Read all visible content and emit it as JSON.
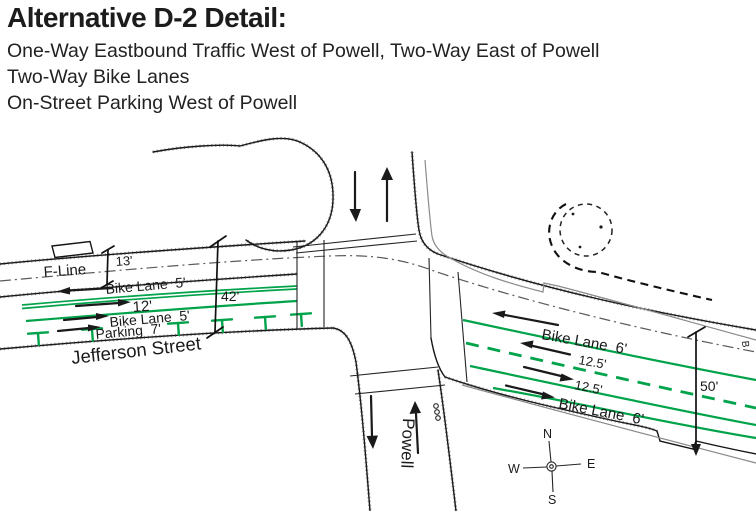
{
  "header": {
    "title": "Alternative D-2 Detail:",
    "line1": "One-Way Eastbound Traffic West of Powell, Two-Way East of Powell",
    "line2": "Two-Way Bike Lanes",
    "line3": "On-Street Parking West of Powell"
  },
  "diagram": {
    "west": {
      "f_line_label": "F-Line",
      "dim_transit": "13'",
      "bike_lane_top": "Bike Lane  5'",
      "travel_lane": "12'",
      "bike_lane_bottom": "Bike Lane  5'",
      "parking_label": "Parking  7'",
      "street_name": "Jefferson Street",
      "dim_total": "42'"
    },
    "east": {
      "bike_lane_top": "Bike Lane  6'",
      "travel_lane_wb": "12.5'",
      "travel_lane_eb": "12.5'",
      "bike_lane_bottom": "Bike Lane  6'",
      "dim_total": "50'",
      "edge_letter": "B"
    },
    "cross_street": "Powell",
    "compass": {
      "north": "N",
      "south": "S",
      "east": "E",
      "west": "W"
    },
    "colors": {
      "bike_lane_green": "#00a34a",
      "ink": "#1a1a1a",
      "line_gray": "#8a8a8a"
    }
  }
}
